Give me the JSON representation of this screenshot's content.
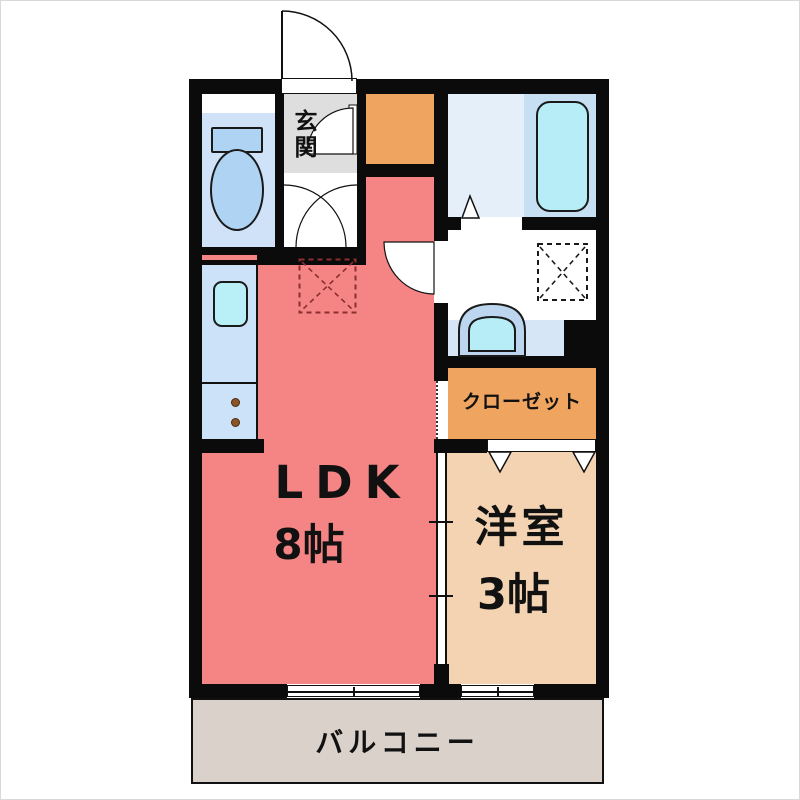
{
  "plan_title": "1K apartment floor plan",
  "labels": {
    "entrance": "玄関",
    "ldk_name": "LDK",
    "ldk_size": "8帖",
    "western_name": "洋室",
    "western_size": "3帖",
    "closet": "クローゼット",
    "balcony": "バルコニー"
  },
  "colors": {
    "wall": "#0b0b0b",
    "ldk_floor": "#F58585",
    "western_floor": "#F3D3B2",
    "closet_fill": "#EFA55F",
    "storage_fill": "#EFA55F",
    "balcony_fill": "#D9D1CA",
    "entrance_fill": "#DEDEDE",
    "toilet_floor": "#CFE2F7",
    "fixture_blue": "#AFD3F2",
    "bathroom_floor": "#E5EFFA",
    "bathtub_zone": "#C6DFF3",
    "bathtub_water": "#B7EDF6",
    "kitchen_counter": "#CBE2F8",
    "sink_water": "#B9F0F8",
    "basin_outer": "#BCD6F0",
    "counter_band": "#D7E6F7",
    "burner_dot": "#8B5526",
    "fridge_dash": "#8B2E2E"
  },
  "fixtures": [
    "toilet",
    "bathtub",
    "washbasin",
    "kitchen-sink",
    "stove-burners",
    "refrigerator-space",
    "washing-machine-space",
    "entrance-door-swing",
    "hall-door-swings",
    "washroom-door-swing",
    "bathroom-folding-door",
    "closet-hinged-doors",
    "sliding-door",
    "balcony-windows"
  ]
}
